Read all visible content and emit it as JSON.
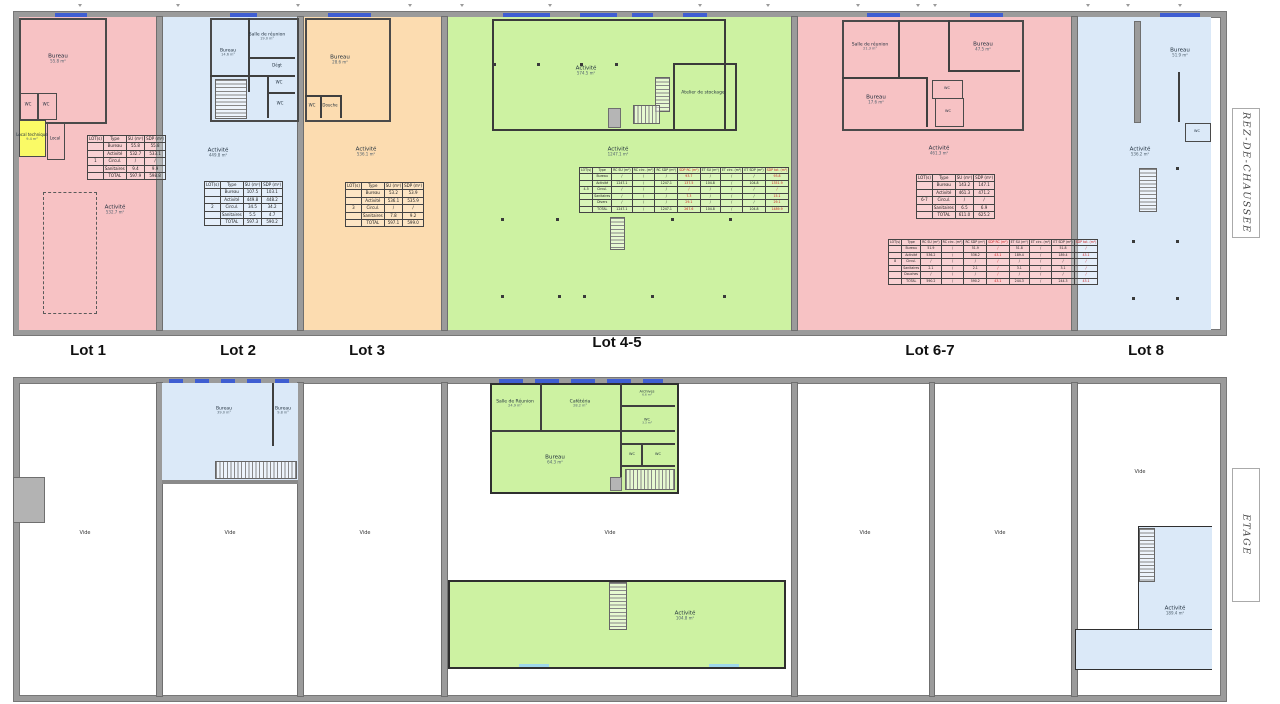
{
  "side_labels": {
    "ground": "REZ-DE-CHAUSSEE",
    "upper": "ETAGE"
  },
  "lot_labels": {
    "l1": "Lot 1",
    "l2": "Lot 2",
    "l3": "Lot 3",
    "l45": "Lot 4-5",
    "l67": "Lot 6-7",
    "l8": "Lot 8"
  },
  "colors": {
    "pink": "#f7c2c4",
    "blue": "#dbe9f8",
    "orange": "#fcdcb0",
    "green": "#cdf2a2",
    "yellow": "#fafa66",
    "wall_gray": "#9b9b9b",
    "window_blue": "#3f5ed2",
    "table_red": "#cc2222"
  },
  "ground": {
    "lot1": {
      "bureau": {
        "n": "Bureau",
        "a": "55.8 m²"
      },
      "wc1": {
        "n": "WC"
      },
      "wc2": {
        "n": "WC"
      },
      "loctech": {
        "n": "Local technique",
        "a": "9.4 m²"
      },
      "local": {
        "n": "Local",
        "a": "5.1 m²"
      },
      "act": {
        "n": "Activité",
        "a": "532.7 m²"
      },
      "table": {
        "headers": [
          "LOT(s)",
          "Type",
          "SU (m²)",
          "SDP (m²)"
        ],
        "rows": [
          [
            "",
            "Bureau",
            "55.8",
            "55.8"
          ],
          [
            "",
            "Activité",
            "532.7",
            "533.1"
          ],
          [
            "1",
            "Circul.",
            "/",
            "/"
          ],
          [
            "",
            "Sanitaires",
            "9.4",
            "9.9"
          ],
          [
            "",
            "TOTAL",
            "597.9",
            "598.8"
          ]
        ]
      }
    },
    "lot2": {
      "salle": {
        "n": "Salle de réunion",
        "a": "19.0 m²"
      },
      "bureau": {
        "n": "Bureau",
        "a": "14.6 m²"
      },
      "degt": {
        "n": "Dégt"
      },
      "wc1": {
        "n": "WC"
      },
      "wc2": {
        "n": "WC"
      },
      "act": {
        "n": "Activité",
        "a": "449.8 m²"
      },
      "table": {
        "headers": [
          "LOT(s)",
          "Type",
          "SU (m²)",
          "SDP (m²)"
        ],
        "rows": [
          [
            "",
            "Bureau",
            "107.5",
            "103.1"
          ],
          [
            "",
            "Activité",
            "449.8",
            "448.2"
          ],
          [
            "2",
            "Circul.",
            "34.5",
            "34.2"
          ],
          [
            "",
            "Sanitaires",
            "5.5",
            "4.7"
          ],
          [
            "",
            "TOTAL",
            "597.3",
            "590.2"
          ]
        ]
      }
    },
    "lot3": {
      "bureau": {
        "n": "Bureau",
        "a": "28.6 m²"
      },
      "wc": {
        "n": "WC"
      },
      "douche": {
        "n": "Douche"
      },
      "act": {
        "n": "Activité",
        "a": "536.1 m²"
      },
      "table": {
        "headers": [
          "LOT(s)",
          "Type",
          "SU (m²)",
          "SDP (m²)"
        ],
        "rows": [
          [
            "",
            "Bureau",
            "53.2",
            "53.9"
          ],
          [
            "",
            "Activité",
            "536.1",
            "535.9"
          ],
          [
            "3",
            "Circul.",
            "/",
            "/"
          ],
          [
            "",
            "Sanitaires",
            "7.8",
            "9.2"
          ],
          [
            "",
            "TOTAL",
            "597.1",
            "599.0"
          ]
        ]
      }
    },
    "lot45": {
      "act_top": {
        "n": "Activité",
        "a": "574.5 m²"
      },
      "atelier": {
        "n": "Atelier de stockage"
      },
      "act_main": {
        "n": "Activité",
        "a": "1247.1 m²"
      },
      "table": {
        "headers": [
          "LOT(s)",
          "Type",
          "RC SU (m²)",
          "RC circ. (m²)",
          "RC SDP (m²)",
          "SDP RC (m²)",
          "ET SU (m²)",
          "ET circ. (m²)",
          "ET SDP (m²)",
          "SDP tot. (m²)"
        ],
        "red_cols": [
          5,
          9
        ],
        "rows": [
          [
            "",
            "Bureau",
            "/",
            "/",
            "/",
            "93.7",
            "/",
            "/",
            "/",
            "93.8"
          ],
          [
            "",
            "Activité",
            "1247.1",
            "/",
            "1247.1",
            "137.5",
            "104.8",
            "/",
            "104.8",
            "1351.9"
          ],
          [
            "4-5",
            "Circul.",
            "/",
            "/",
            "/",
            "/",
            "/",
            "/",
            "/",
            "/"
          ],
          [
            "",
            "Sanitaires",
            "/",
            "/",
            "/",
            "7.3",
            "/",
            "/",
            "/",
            "15.1"
          ],
          [
            "",
            "Divers",
            "/",
            "/",
            "/",
            "29.1",
            "/",
            "/",
            "/",
            "29.1"
          ],
          [
            "",
            "TOTAL",
            "1247.1",
            "/",
            "1247.1",
            "267.6",
            "104.8",
            "/",
            "104.8",
            "1489.9"
          ]
        ]
      }
    },
    "lot67": {
      "salle": {
        "n": "Salle de réunion",
        "a": "21.3 m²"
      },
      "bureau1": {
        "n": "Bureau",
        "a": "47.5 m²"
      },
      "bureau2": {
        "n": "Bureau",
        "a": "17.6 m²"
      },
      "wc1": {
        "n": "WC",
        "a": "2.1 m²"
      },
      "wc2": {
        "n": "WC",
        "a": "3.1 m²"
      },
      "act": {
        "n": "Activité",
        "a": "461.3 m²"
      },
      "table": {
        "headers": [
          "LOT(s)",
          "Type",
          "SU (m²)",
          "SDP (m²)"
        ],
        "rows": [
          [
            "",
            "Bureau",
            "143.2",
            "147.1"
          ],
          [
            "",
            "Activité",
            "461.3",
            "471.2"
          ],
          [
            "6-7",
            "Circul.",
            "/",
            "/"
          ],
          [
            "",
            "Sanitaires",
            "6.5",
            "6.9"
          ],
          [
            "",
            "TOTAL",
            "611.0",
            "625.2"
          ]
        ]
      }
    },
    "lot8": {
      "bureau": {
        "n": "Bureau",
        "a": "51.9 m²"
      },
      "wc": {
        "n": "WC"
      },
      "act": {
        "n": "Activité",
        "a": "536.2 m²"
      },
      "table": {
        "headers": [
          "LOT(s)",
          "Type",
          "RC SU (m²)",
          "RC circ. (m²)",
          "RC SDP (m²)",
          "SDP RC (m²)",
          "ET SU (m²)",
          "ET circ. (m²)",
          "ET SDP (m²)",
          "SDP tot. (m²)"
        ],
        "red_cols": [
          5,
          9
        ],
        "rows": [
          [
            "",
            "Bureau",
            "51.9",
            "/",
            "51.9",
            "/",
            "51.8",
            "/",
            "51.8",
            "/"
          ],
          [
            "",
            "Activité",
            "536.2",
            "/",
            "536.2",
            "43.1",
            "189.4",
            "/",
            "189.4",
            "43.1"
          ],
          [
            "8",
            "Circul.",
            "/",
            "/",
            "/",
            "/",
            "/",
            "/",
            "/",
            "/"
          ],
          [
            "",
            "Sanitaires",
            "2.1",
            "/",
            "2.1",
            "/",
            "3.1",
            "/",
            "3.1",
            "/"
          ],
          [
            "",
            "Douches",
            "/",
            "/",
            "/",
            "/",
            "/",
            "/",
            "/",
            "/"
          ],
          [
            "",
            "TOTAL",
            "590.2",
            "/",
            "590.2",
            "43.1",
            "244.3",
            "/",
            "244.3",
            "43.1"
          ]
        ]
      }
    }
  },
  "etage": {
    "lot1": {
      "vide": "Vide"
    },
    "lot2": {
      "bureau1": {
        "n": "Bureau",
        "a": "39.0 m²"
      },
      "bureau2": {
        "n": "Bureau",
        "a": "9.8 m²"
      },
      "vide": "Vide"
    },
    "lot3": {
      "vide": "Vide"
    },
    "lot45": {
      "salle": {
        "n": "Salle de Réunion",
        "a": "24.9 m²"
      },
      "cafeteria": {
        "n": "Cafétéria",
        "a": "28.2 m²"
      },
      "archives": {
        "n": "Archives",
        "a": "6.6 m²"
      },
      "wc_top": {
        "n": "WC",
        "a": "3.3 m²"
      },
      "bureau": {
        "n": "Bureau",
        "a": "64.3 m²"
      },
      "wc1": {
        "n": "WC"
      },
      "wc2": {
        "n": "WC"
      },
      "vide": "Vide",
      "act": {
        "n": "Activité",
        "a": "104.8 m²"
      }
    },
    "lot67": {
      "vide1": "Vide",
      "vide2": "Vide"
    },
    "lot8": {
      "vide": "Vide",
      "act": {
        "n": "Activité",
        "a": "189.4 m²"
      }
    }
  }
}
